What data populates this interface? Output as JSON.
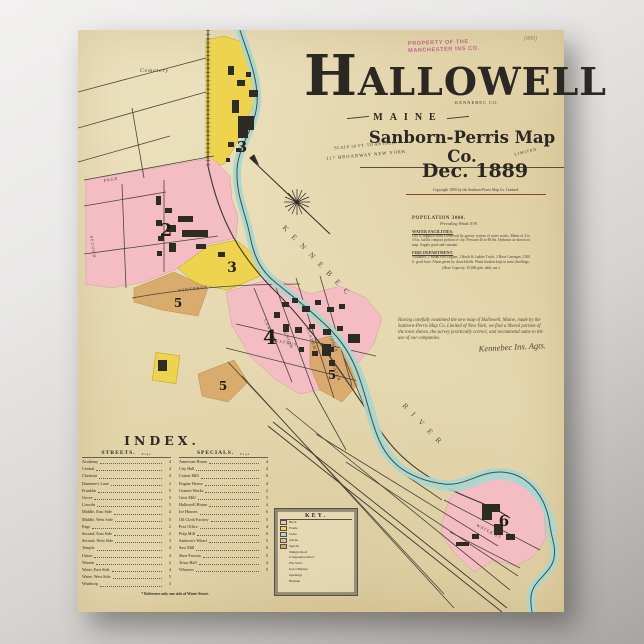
{
  "stamp": {
    "line1": "PROPERTY OF THE",
    "line2": "MANCHESTER INS CO.",
    "number": "(990)"
  },
  "title": {
    "city": "HALLOWELL",
    "county": "KENNEBEC CO.",
    "state": "MAINE",
    "publisher": "Sanborn-Perris Map Co.",
    "limited": "LIMITED",
    "scale": "SCALE 50 FT. TO AN INCH.",
    "address": "117 BROADWAY NEW YORK",
    "date": "Dec. 1889",
    "copyright": "Copyright 1890 by the Sanborn-Perris Map Co. Limited."
  },
  "population": {
    "line1": "POPULATION 3000.",
    "line2": "Prevailing Winds N.W.",
    "water_heading": "WATER FACILITIES.",
    "water_text": "City is supplied from a reservoir by gravity system of water works. Mains of 4 to 10 in. laid in compact portion of city. Pressure 40 to 80 lbs. Hydrants as shown on map. Supply good and constant.",
    "fire_heading": "FIRE DEPARTMENT.",
    "fire_text": "Volunteer. 1 Steam Fire Engine, 1 Hook & Ladder Truck, 2 Hose Carriages, 1500 ft. good hose. Alarm given by church bells. Water buckets kept in most dwellings.",
    "footer": "(Hose Capacity: 10,000 gals. daily use.)"
  },
  "note": {
    "text": "Having carefully examined the new map of Hallowell, Maine, made by the Sanborn-Perris Map Co. Limited of New York, we find a liberal portion of the town shown, the survey practically correct, and recommend same to the use of our companies.",
    "signature": "Kennebec Ins. Agts."
  },
  "index": {
    "title": "INDEX.",
    "streets_header": "STREETS.",
    "specials_header": "SPECIALS.",
    "page_label": "Page",
    "streets": [
      {
        "n": "Academy",
        "p": "4"
      },
      {
        "n": "Central",
        "p": "4"
      },
      {
        "n": "Chestnut",
        "p": "4"
      },
      {
        "n": "Dummer's Lane",
        "p": "2"
      },
      {
        "n": "Franklin",
        "p": "5"
      },
      {
        "n": "Grove",
        "p": "3"
      },
      {
        "n": "Lincoln",
        "p": "5"
      },
      {
        "n": "Middle, East Side",
        "p": "4"
      },
      {
        "n": "Middle, West Side",
        "p": "5"
      },
      {
        "n": "Page",
        "p": "2"
      },
      {
        "n": "Second, East Side",
        "p": "2"
      },
      {
        "n": "Second, West Side",
        "p": "3"
      },
      {
        "n": "Temple",
        "p": "4"
      },
      {
        "n": "Union",
        "p": "4"
      },
      {
        "n": "Warren",
        "p": "2"
      },
      {
        "n": "Water, East Side",
        "p": "4"
      },
      {
        "n": "Water, West Side",
        "p": "5"
      },
      {
        "n": "Winthrop",
        "p": "3"
      }
    ],
    "specials": [
      {
        "n": "American House",
        "p": "4"
      },
      {
        "n": "City Hall",
        "p": "4"
      },
      {
        "n": "Cotton Mill",
        "p": "6"
      },
      {
        "n": "Engine House",
        "p": "4"
      },
      {
        "n": "Granite Works",
        "p": "2"
      },
      {
        "n": "Grist Mill",
        "p": "5"
      },
      {
        "n": "Hallowell House",
        "p": "4"
      },
      {
        "n": "Ice Houses",
        "p": "6"
      },
      {
        "n": "Oil Cloth Factory",
        "p": "5"
      },
      {
        "n": "Post Office",
        "p": "4"
      },
      {
        "n": "Pulp Mill",
        "p": "6"
      },
      {
        "n": "Sanborn's Wharf",
        "p": "5"
      },
      {
        "n": "Saw Mill",
        "p": "6"
      },
      {
        "n": "Shoe Factory",
        "p": "5"
      },
      {
        "n": "Town Hall",
        "p": "4"
      },
      {
        "n": "Wharves",
        "p": "5"
      }
    ],
    "footnote": "* Reference only one side of Water Street."
  },
  "key": {
    "title": "KEY.",
    "rows": [
      {
        "t": "Brick",
        "c": "#f4bdc4"
      },
      {
        "t": "Frame",
        "c": "#eed34f"
      },
      {
        "t": "Stone",
        "c": "#b9cfe0"
      },
      {
        "t": "Adobe",
        "c": "#cfc3a6"
      },
      {
        "t": "Special",
        "c": "#d8a766"
      },
      {
        "t": "Shingle Roof",
        "c": ""
      },
      {
        "t": "Composition Roof",
        "c": ""
      },
      {
        "t": "Fire Wall",
        "c": ""
      },
      {
        "t": "Iron Chimney",
        "c": ""
      },
      {
        "t": "Openings",
        "c": ""
      },
      {
        "t": "Hydrant",
        "c": ""
      }
    ]
  },
  "map": {
    "cemetery": "Cemetery",
    "kennebec": "KENNEBEC",
    "river": "RIVER",
    "numerals": {
      "d2": "2",
      "d3a": "3",
      "d3b": "3",
      "d4": "4",
      "d5a": "5",
      "d5b": "5",
      "d5c": "5",
      "d6": "6"
    },
    "streets": {
      "page": "PAGE",
      "second": "SECOND",
      "winthrop": "WINTHROP",
      "central": "CENTRAL",
      "union": "UNION",
      "academy": "ACADEMY",
      "middle": "MIDDLE",
      "water": "WATER",
      "chestnut": "CHESTNUT",
      "water_st": "WATER ST"
    },
    "colors": {
      "pink": "#f4bdc4",
      "yellow": "#eed34f",
      "tan": "#d8a766",
      "river": "#a7d7d0",
      "ink": "#2b2722"
    }
  }
}
